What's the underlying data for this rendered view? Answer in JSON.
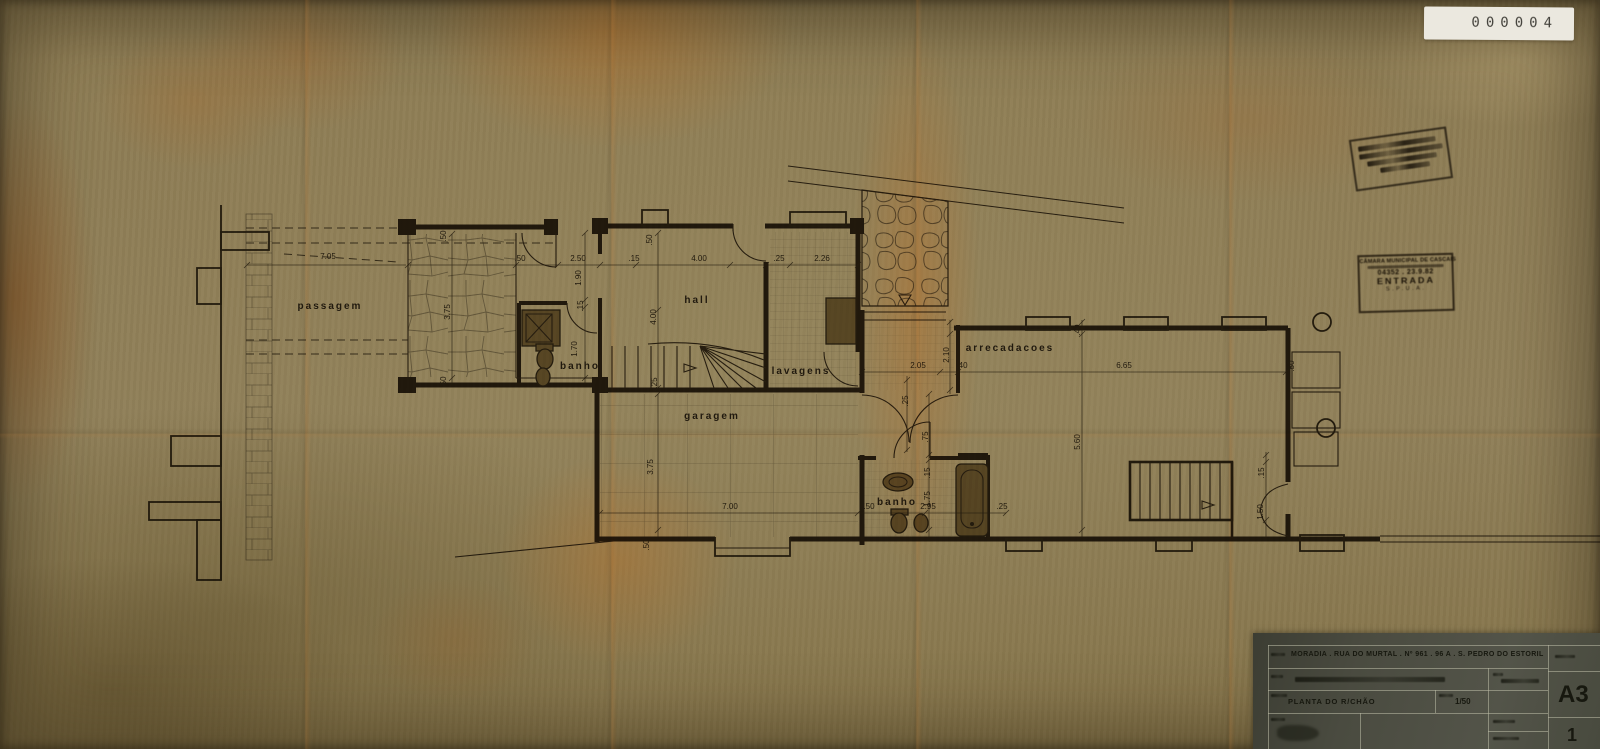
{
  "sticker": {
    "number": "000004"
  },
  "stamps": {
    "entry": {
      "authority": "CÂMARA MUNICIPAL DE CASCAIS",
      "number_date": "04352 . 23.9.82",
      "word": "ENTRADA",
      "department": "S.P.U.A."
    }
  },
  "title_block": {
    "project": "MORADIA . RUA DO MURTAL . Nº 961 . 96 A . S. PEDRO DO ESTORIL",
    "drawing_title": "PLANTA DO R/CHÃO",
    "scale": "1/50",
    "format": "A3",
    "sheet": "1"
  },
  "plan": {
    "texts": [
      {
        "t": "passagem",
        "x": 330,
        "y": 309,
        "cls": "room"
      },
      {
        "t": "banho",
        "x": 580,
        "y": 369,
        "cls": "room",
        "s": 9
      },
      {
        "t": "hall",
        "x": 697,
        "y": 303,
        "cls": "room"
      },
      {
        "t": "lavagens",
        "x": 801,
        "y": 374,
        "cls": "room",
        "s": 9
      },
      {
        "t": "garagem",
        "x": 712,
        "y": 419,
        "cls": "room"
      },
      {
        "t": "arrecadacoes",
        "x": 1010,
        "y": 351,
        "cls": "room",
        "s": 9
      },
      {
        "t": "banho",
        "x": 897,
        "y": 505,
        "cls": "room",
        "s": 9
      },
      {
        "t": "7.05",
        "x": 328,
        "y": 259,
        "cls": "dim"
      },
      {
        "t": ".50",
        "x": 520,
        "y": 261,
        "cls": "dim"
      },
      {
        "t": "2.50",
        "x": 578,
        "y": 261,
        "cls": "dim"
      },
      {
        "t": ".15",
        "x": 634,
        "y": 261,
        "cls": "dim"
      },
      {
        "t": "4.00",
        "x": 699,
        "y": 261,
        "cls": "dim"
      },
      {
        "t": ".25",
        "x": 779,
        "y": 261,
        "cls": "dim"
      },
      {
        "t": "2.26",
        "x": 822,
        "y": 261,
        "cls": "dim"
      },
      {
        "t": "7.00",
        "x": 730,
        "y": 509,
        "cls": "dim"
      },
      {
        "t": "2.05",
        "x": 918,
        "y": 368,
        "cls": "dim"
      },
      {
        "t": ".40",
        "x": 962,
        "y": 368,
        "cls": "dim"
      },
      {
        "t": "6.65",
        "x": 1124,
        "y": 368,
        "cls": "dim"
      },
      {
        "t": ".50",
        "x": 869,
        "y": 509,
        "cls": "dim"
      },
      {
        "t": "2.95",
        "x": 928,
        "y": 509,
        "cls": "dim"
      },
      {
        "t": ".25",
        "x": 1002,
        "y": 509,
        "cls": "dim"
      },
      {
        "t": ".50",
        "x": 446,
        "y": 236,
        "r": -90,
        "cls": "dim"
      },
      {
        "t": ".50",
        "x": 652,
        "y": 240,
        "r": -90,
        "cls": "dim"
      },
      {
        "t": ".50",
        "x": 446,
        "y": 382,
        "r": -90,
        "cls": "dim"
      },
      {
        "t": "3.75",
        "x": 450,
        "y": 312,
        "r": -90,
        "cls": "dim"
      },
      {
        "t": "1.90",
        "x": 581,
        "y": 278,
        "r": -90,
        "cls": "dim"
      },
      {
        "t": ".15",
        "x": 583,
        "y": 306,
        "r": -90,
        "cls": "dim"
      },
      {
        "t": "1.70",
        "x": 577,
        "y": 349,
        "r": -90,
        "cls": "dim"
      },
      {
        "t": "4.00",
        "x": 656,
        "y": 317,
        "r": -90,
        "cls": "dim"
      },
      {
        "t": ".25",
        "x": 657,
        "y": 383,
        "r": -90,
        "cls": "dim"
      },
      {
        "t": "3.75",
        "x": 653,
        "y": 467,
        "r": -90,
        "cls": "dim"
      },
      {
        "t": ".50",
        "x": 649,
        "y": 545,
        "r": -90,
        "cls": "dim"
      },
      {
        "t": "2.10",
        "x": 949,
        "y": 355,
        "r": -90,
        "cls": "dim"
      },
      {
        "t": ".40",
        "x": 1080,
        "y": 330,
        "r": -90,
        "cls": "dim"
      },
      {
        "t": ".50",
        "x": 1294,
        "y": 366,
        "r": -90,
        "cls": "dim"
      },
      {
        "t": "5.60",
        "x": 1080,
        "y": 442,
        "r": -90,
        "cls": "dim"
      },
      {
        "t": ".25",
        "x": 908,
        "y": 401,
        "r": -90,
        "cls": "dim"
      },
      {
        "t": ".75",
        "x": 928,
        "y": 437,
        "r": -90,
        "cls": "dim"
      },
      {
        "t": ".15",
        "x": 930,
        "y": 473,
        "r": -90,
        "cls": "dim"
      },
      {
        "t": "1.75",
        "x": 930,
        "y": 499,
        "r": -90,
        "cls": "dim"
      },
      {
        "t": ".15",
        "x": 1264,
        "y": 473,
        "r": -90,
        "cls": "dim"
      },
      {
        "t": "1.50",
        "x": 1263,
        "y": 512,
        "r": -90,
        "cls": "dim"
      }
    ]
  }
}
